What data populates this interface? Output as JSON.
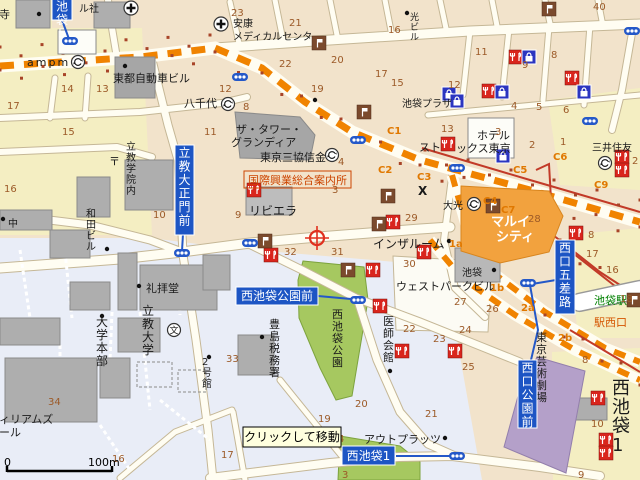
{
  "map_title": "西池袋・池袋駅西口周辺地図",
  "palette": {
    "base_block": "#F2E3CB",
    "yellow_block": "#F4EEC2",
    "lightblue_block": "#E9EDF7",
    "road_fill": "#FFFDF2",
    "road_casing": "#C5B796",
    "rail_orange": "#F08300",
    "metro_red": "#C23A28",
    "subway_blue": "#2458C8",
    "sign_blue": "#1D55C4",
    "park_green": "#A6C860",
    "theatre_purple": "#B4A0C9",
    "marui_orange": "#F2A23E",
    "building_gray": "#AEAEAE",
    "number_brown": "#9C5A28",
    "exit_orange": "#E07800",
    "station_green_text": "#008000",
    "west_exit_red_text": "#D45500",
    "restaurant_icon_red": "#D9251D",
    "shopping_icon_blue": "#2B35C0",
    "flag_icon_brown": "#7B4A2D"
  },
  "texts": [
    {
      "t": "寺",
      "x": -1,
      "y": 18,
      "s": 11
    },
    {
      "t": "ル社",
      "x": 79,
      "y": 12,
      "s": 10
    },
    {
      "t": "ampm",
      "x": 27,
      "y": 66,
      "s": 11,
      "ls": 2
    },
    {
      "t": "東都自動車ビル",
      "x": 113,
      "y": 82,
      "s": 11
    },
    {
      "t": "八千代",
      "x": 184,
      "y": 107,
      "s": 11
    },
    {
      "t": "安康",
      "x": 233,
      "y": 27,
      "s": 10
    },
    {
      "t": "メディカルセンタ",
      "x": 233,
      "y": 40,
      "s": 10
    },
    {
      "t": "光ビル",
      "x": 410,
      "y": 20,
      "s": 9,
      "v": 1
    },
    {
      "t": "池袋プラザ",
      "x": 402,
      "y": 107,
      "s": 10
    },
    {
      "t": "ザ・タワー・",
      "x": 236,
      "y": 133,
      "s": 11
    },
    {
      "t": "グランディア",
      "x": 231,
      "y": 146,
      "s": 11
    },
    {
      "t": "東京三協信金",
      "x": 260,
      "y": 161,
      "s": 11
    },
    {
      "t": "国際興業総合案内所",
      "x": 248,
      "y": 184,
      "s": 11,
      "c": "#CC4400",
      "bx": 1
    },
    {
      "t": "リビエラ",
      "x": 249,
      "y": 215,
      "s": 12
    },
    {
      "t": "立教学院内",
      "x": 126,
      "y": 150,
      "s": 10,
      "v": 1
    },
    {
      "t": "〒",
      "x": 109,
      "y": 165,
      "s": 11
    },
    {
      "t": "和田ビル",
      "x": 86,
      "y": 217,
      "s": 10,
      "v": 1
    },
    {
      "t": "中",
      "x": 8,
      "y": 227,
      "s": 10
    },
    {
      "t": "礼拝堂",
      "x": 146,
      "y": 292,
      "s": 11
    },
    {
      "t": "大学本部",
      "x": 96,
      "y": 326,
      "s": 12,
      "v": 1
    },
    {
      "t": "立教大学",
      "x": 142,
      "y": 315,
      "s": 12,
      "v": 1
    },
    {
      "t": "豊島税務署",
      "x": 269,
      "y": 328,
      "s": 11,
      "v": 1
    },
    {
      "t": "医師会館",
      "x": 383,
      "y": 325,
      "s": 11,
      "v": 1
    },
    {
      "t": "西池袋公園",
      "x": 332,
      "y": 318,
      "s": 11,
      "v": 1
    },
    {
      "t": "インザルーム",
      "x": 373,
      "y": 248,
      "s": 12
    },
    {
      "t": "ウェストパークビル",
      "x": 396,
      "y": 290,
      "s": 11
    },
    {
      "t": "池袋",
      "x": 462,
      "y": 276,
      "s": 10
    },
    {
      "t": "池袋駅",
      "x": 594,
      "y": 304,
      "s": 11,
      "c": "#008000"
    },
    {
      "t": "駅西口",
      "x": 594,
      "y": 326,
      "s": 11,
      "c": "#D45500"
    },
    {
      "t": "東京芸術劇場",
      "x": 536,
      "y": 341,
      "s": 11,
      "v": 1
    },
    {
      "t": "アウトプラッツ",
      "x": 364,
      "y": 443,
      "s": 11
    },
    {
      "t": "ウィリアムズ",
      "x": -12,
      "y": 423,
      "s": 11
    },
    {
      "t": "ホール",
      "x": -12,
      "y": 436,
      "s": 11
    },
    {
      "t": "2号館",
      "x": 202,
      "y": 365,
      "s": 10,
      "v": 1
    },
    {
      "t": "西池袋1",
      "x": 612,
      "y": 394,
      "s": 18,
      "v": 1
    },
    {
      "t": "ホテル",
      "x": 477,
      "y": 139,
      "s": 11
    },
    {
      "t": "スト",
      "x": 419,
      "y": 151,
      "s": 11
    },
    {
      "t": "ックス東京",
      "x": 456,
      "y": 152,
      "s": 11
    },
    {
      "t": "三井住友",
      "x": 592,
      "y": 151,
      "s": 10
    },
    {
      "t": "大光",
      "x": 443,
      "y": 209,
      "s": 10
    },
    {
      "t": "マルイ",
      "x": 491,
      "y": 226,
      "s": 13,
      "c": "#FFFFFF",
      "b": 1
    },
    {
      "t": "シティ",
      "x": 496,
      "y": 241,
      "s": 13,
      "c": "#FFFFFF",
      "b": 1
    },
    {
      "t": "X",
      "x": 418,
      "y": 195,
      "s": 12,
      "b": 1
    }
  ],
  "block_numbers": [
    {
      "t": "14",
      "x": 61,
      "y": 92
    },
    {
      "t": "13",
      "x": 96,
      "y": 92
    },
    {
      "t": "17",
      "x": 7,
      "y": 109
    },
    {
      "t": "23",
      "x": 231,
      "y": 16
    },
    {
      "t": "21",
      "x": 289,
      "y": 26
    },
    {
      "t": "16",
      "x": 388,
      "y": 33
    },
    {
      "t": "22",
      "x": 279,
      "y": 67
    },
    {
      "t": "20",
      "x": 331,
      "y": 63
    },
    {
      "t": "17",
      "x": 375,
      "y": 77
    },
    {
      "t": "15",
      "x": 391,
      "y": 86
    },
    {
      "t": "19",
      "x": 311,
      "y": 92
    },
    {
      "t": "12",
      "x": 219,
      "y": 92
    },
    {
      "t": "8",
      "x": 243,
      "y": 110
    },
    {
      "t": "40",
      "x": 593,
      "y": 10
    },
    {
      "t": "11",
      "x": 475,
      "y": 55
    },
    {
      "t": "8",
      "x": 551,
      "y": 58
    },
    {
      "t": "9",
      "x": 522,
      "y": 68
    },
    {
      "t": "12",
      "x": 448,
      "y": 88
    },
    {
      "t": "4",
      "x": 511,
      "y": 109
    },
    {
      "t": "5",
      "x": 536,
      "y": 110
    },
    {
      "t": "6",
      "x": 563,
      "y": 113
    },
    {
      "t": "13",
      "x": 441,
      "y": 132
    },
    {
      "t": "3",
      "x": 495,
      "y": 135
    },
    {
      "t": "2",
      "x": 529,
      "y": 148
    },
    {
      "t": "1",
      "x": 560,
      "y": 145
    },
    {
      "t": "15",
      "x": 62,
      "y": 135
    },
    {
      "t": "11",
      "x": 204,
      "y": 135
    },
    {
      "t": "16",
      "x": 4,
      "y": 192
    },
    {
      "t": "10",
      "x": 153,
      "y": 218
    },
    {
      "t": "4",
      "x": 338,
      "y": 165
    },
    {
      "t": "3",
      "x": 332,
      "y": 193
    },
    {
      "t": "9",
      "x": 235,
      "y": 218
    },
    {
      "t": "29",
      "x": 405,
      "y": 221
    },
    {
      "t": "32",
      "x": 284,
      "y": 255
    },
    {
      "t": "31",
      "x": 331,
      "y": 255
    },
    {
      "t": "30",
      "x": 403,
      "y": 267
    },
    {
      "t": "28",
      "x": 528,
      "y": 222
    },
    {
      "t": "17",
      "x": 586,
      "y": 257
    },
    {
      "t": "16",
      "x": 606,
      "y": 273
    },
    {
      "t": "18",
      "x": 620,
      "y": 302
    },
    {
      "t": "27",
      "x": 454,
      "y": 305
    },
    {
      "t": "26",
      "x": 486,
      "y": 312
    },
    {
      "t": "24",
      "x": 459,
      "y": 333
    },
    {
      "t": "23",
      "x": 433,
      "y": 342
    },
    {
      "t": "22",
      "x": 403,
      "y": 332
    },
    {
      "t": "33",
      "x": 226,
      "y": 362
    },
    {
      "t": "34",
      "x": 48,
      "y": 405
    },
    {
      "t": "16",
      "x": 112,
      "y": 462
    },
    {
      "t": "17",
      "x": 221,
      "y": 458
    },
    {
      "t": "19",
      "x": 318,
      "y": 422
    },
    {
      "t": "20",
      "x": 355,
      "y": 407
    },
    {
      "t": "4",
      "x": 338,
      "y": 442
    },
    {
      "t": "3",
      "x": 342,
      "y": 478
    },
    {
      "t": "25",
      "x": 462,
      "y": 370
    },
    {
      "t": "21",
      "x": 425,
      "y": 417
    },
    {
      "t": "8",
      "x": 582,
      "y": 363
    },
    {
      "t": "10",
      "x": 591,
      "y": 427
    },
    {
      "t": "9",
      "x": 578,
      "y": 478
    },
    {
      "t": "2",
      "x": 632,
      "y": 164
    },
    {
      "t": "8",
      "x": 588,
      "y": 238
    }
  ],
  "exit_labels": [
    {
      "t": "C1",
      "x": 387,
      "y": 134
    },
    {
      "t": "C2",
      "x": 378,
      "y": 173
    },
    {
      "t": "C3",
      "x": 417,
      "y": 180
    },
    {
      "t": "C4",
      "x": 483,
      "y": 204
    },
    {
      "t": "C5",
      "x": 513,
      "y": 173
    },
    {
      "t": "C6",
      "x": 553,
      "y": 160
    },
    {
      "t": "C7",
      "x": 501,
      "y": 213
    },
    {
      "t": "C9",
      "x": 594,
      "y": 188
    },
    {
      "t": "1a",
      "x": 449,
      "y": 247
    },
    {
      "t": "1b",
      "x": 490,
      "y": 291
    },
    {
      "t": "2a",
      "x": 521,
      "y": 311
    },
    {
      "t": "2b",
      "x": 558,
      "y": 341
    }
  ],
  "signs": [
    {
      "t": "西池袋5",
      "x": 52,
      "y": -15,
      "w": 20,
      "h": 35,
      "v": 1
    },
    {
      "t": "立教大正門前",
      "x": 175,
      "y": 145,
      "w": 19,
      "h": 90,
      "v": 1
    },
    {
      "t": "西池袋公園前",
      "x": 236,
      "y": 287,
      "w": 82,
      "h": 18
    },
    {
      "t": "西口五差路",
      "x": 555,
      "y": 240,
      "w": 20,
      "h": 74,
      "v": 1
    },
    {
      "t": "西口公園前",
      "x": 518,
      "y": 360,
      "w": 19,
      "h": 68,
      "v": 1
    },
    {
      "t": "西池袋1",
      "x": 342,
      "y": 446,
      "w": 53,
      "h": 19
    }
  ],
  "icons": [
    {
      "k": "hospital",
      "x": 131,
      "y": 8
    },
    {
      "k": "hospital",
      "x": 221,
      "y": 24
    },
    {
      "k": "bank",
      "x": 78,
      "y": 62
    },
    {
      "k": "bank",
      "x": 228,
      "y": 104
    },
    {
      "k": "bank",
      "x": 332,
      "y": 155
    },
    {
      "k": "bank",
      "x": 474,
      "y": 204
    },
    {
      "k": "bank",
      "x": 605,
      "y": 163
    },
    {
      "k": "school",
      "x": 174,
      "y": 330
    },
    {
      "k": "restaurant",
      "x": 254,
      "y": 190
    },
    {
      "k": "restaurant",
      "x": 393,
      "y": 222
    },
    {
      "k": "restaurant",
      "x": 271,
      "y": 255
    },
    {
      "k": "restaurant",
      "x": 373,
      "y": 270
    },
    {
      "k": "restaurant",
      "x": 380,
      "y": 306
    },
    {
      "k": "restaurant",
      "x": 424,
      "y": 252
    },
    {
      "k": "restaurant",
      "x": 448,
      "y": 144
    },
    {
      "k": "restaurant",
      "x": 489,
      "y": 91
    },
    {
      "k": "restaurant",
      "x": 516,
      "y": 57
    },
    {
      "k": "restaurant",
      "x": 572,
      "y": 78
    },
    {
      "k": "restaurant",
      "x": 576,
      "y": 233
    },
    {
      "k": "restaurant",
      "x": 622,
      "y": 157
    },
    {
      "k": "restaurant",
      "x": 622,
      "y": 170
    },
    {
      "k": "restaurant",
      "x": 402,
      "y": 351
    },
    {
      "k": "restaurant",
      "x": 455,
      "y": 351
    },
    {
      "k": "restaurant",
      "x": 598,
      "y": 398
    },
    {
      "k": "restaurant",
      "x": 606,
      "y": 440
    },
    {
      "k": "restaurant",
      "x": 606,
      "y": 453
    },
    {
      "k": "shopping",
      "x": 529,
      "y": 57
    },
    {
      "k": "shopping",
      "x": 584,
      "y": 92
    },
    {
      "k": "shopping",
      "x": 503,
      "y": 156
    },
    {
      "k": "shopping",
      "x": 449,
      "y": 94
    },
    {
      "k": "shopping",
      "x": 457,
      "y": 101
    },
    {
      "k": "shopping",
      "x": 502,
      "y": 92
    },
    {
      "k": "flag",
      "x": 319,
      "y": 43
    },
    {
      "k": "flag",
      "x": 364,
      "y": 112
    },
    {
      "k": "flag",
      "x": 549,
      "y": 9
    },
    {
      "k": "flag",
      "x": 265,
      "y": 241
    },
    {
      "k": "flag",
      "x": 348,
      "y": 270
    },
    {
      "k": "flag",
      "x": 388,
      "y": 196
    },
    {
      "k": "flag",
      "x": 379,
      "y": 224
    },
    {
      "k": "flag",
      "x": 634,
      "y": 300
    },
    {
      "k": "flag",
      "x": 493,
      "y": 206
    },
    {
      "k": "light",
      "x": 70,
      "y": 41
    },
    {
      "k": "light",
      "x": 240,
      "y": 77
    },
    {
      "k": "light",
      "x": 358,
      "y": 140
    },
    {
      "k": "light",
      "x": 457,
      "y": 168
    },
    {
      "k": "light",
      "x": 590,
      "y": 121
    },
    {
      "k": "light",
      "x": 632,
      "y": 31
    },
    {
      "k": "light",
      "x": 182,
      "y": 253
    },
    {
      "k": "light",
      "x": 250,
      "y": 243
    },
    {
      "k": "light",
      "x": 358,
      "y": 300
    },
    {
      "k": "light",
      "x": 528,
      "y": 283
    },
    {
      "k": "light",
      "x": 457,
      "y": 456
    },
    {
      "k": "dot",
      "x": 125,
      "y": 66
    },
    {
      "k": "dot",
      "x": 39,
      "y": 14
    },
    {
      "k": "dot",
      "x": 3,
      "y": 219
    },
    {
      "k": "dot",
      "x": 107,
      "y": 249
    },
    {
      "k": "dot",
      "x": 102,
      "y": 316
    },
    {
      "k": "dot",
      "x": 139,
      "y": 286
    },
    {
      "k": "dot",
      "x": 209,
      "y": 357
    },
    {
      "k": "dot",
      "x": 262,
      "y": 337
    },
    {
      "k": "dot",
      "x": 390,
      "y": 371
    },
    {
      "k": "dot",
      "x": 449,
      "y": 241
    },
    {
      "k": "dot",
      "x": 494,
      "y": 270
    },
    {
      "k": "dot",
      "x": 445,
      "y": 438
    },
    {
      "k": "dot",
      "x": 407,
      "y": 13
    },
    {
      "k": "dot",
      "x": 315,
      "y": 100
    },
    {
      "k": "crosshair",
      "x": 317,
      "y": 238
    }
  ],
  "tooltip": {
    "t": "クリックして移動",
    "x": 243,
    "y": 427,
    "w": 98,
    "h": 20
  },
  "scale_bar": {
    "start": "0",
    "end": "100m"
  }
}
